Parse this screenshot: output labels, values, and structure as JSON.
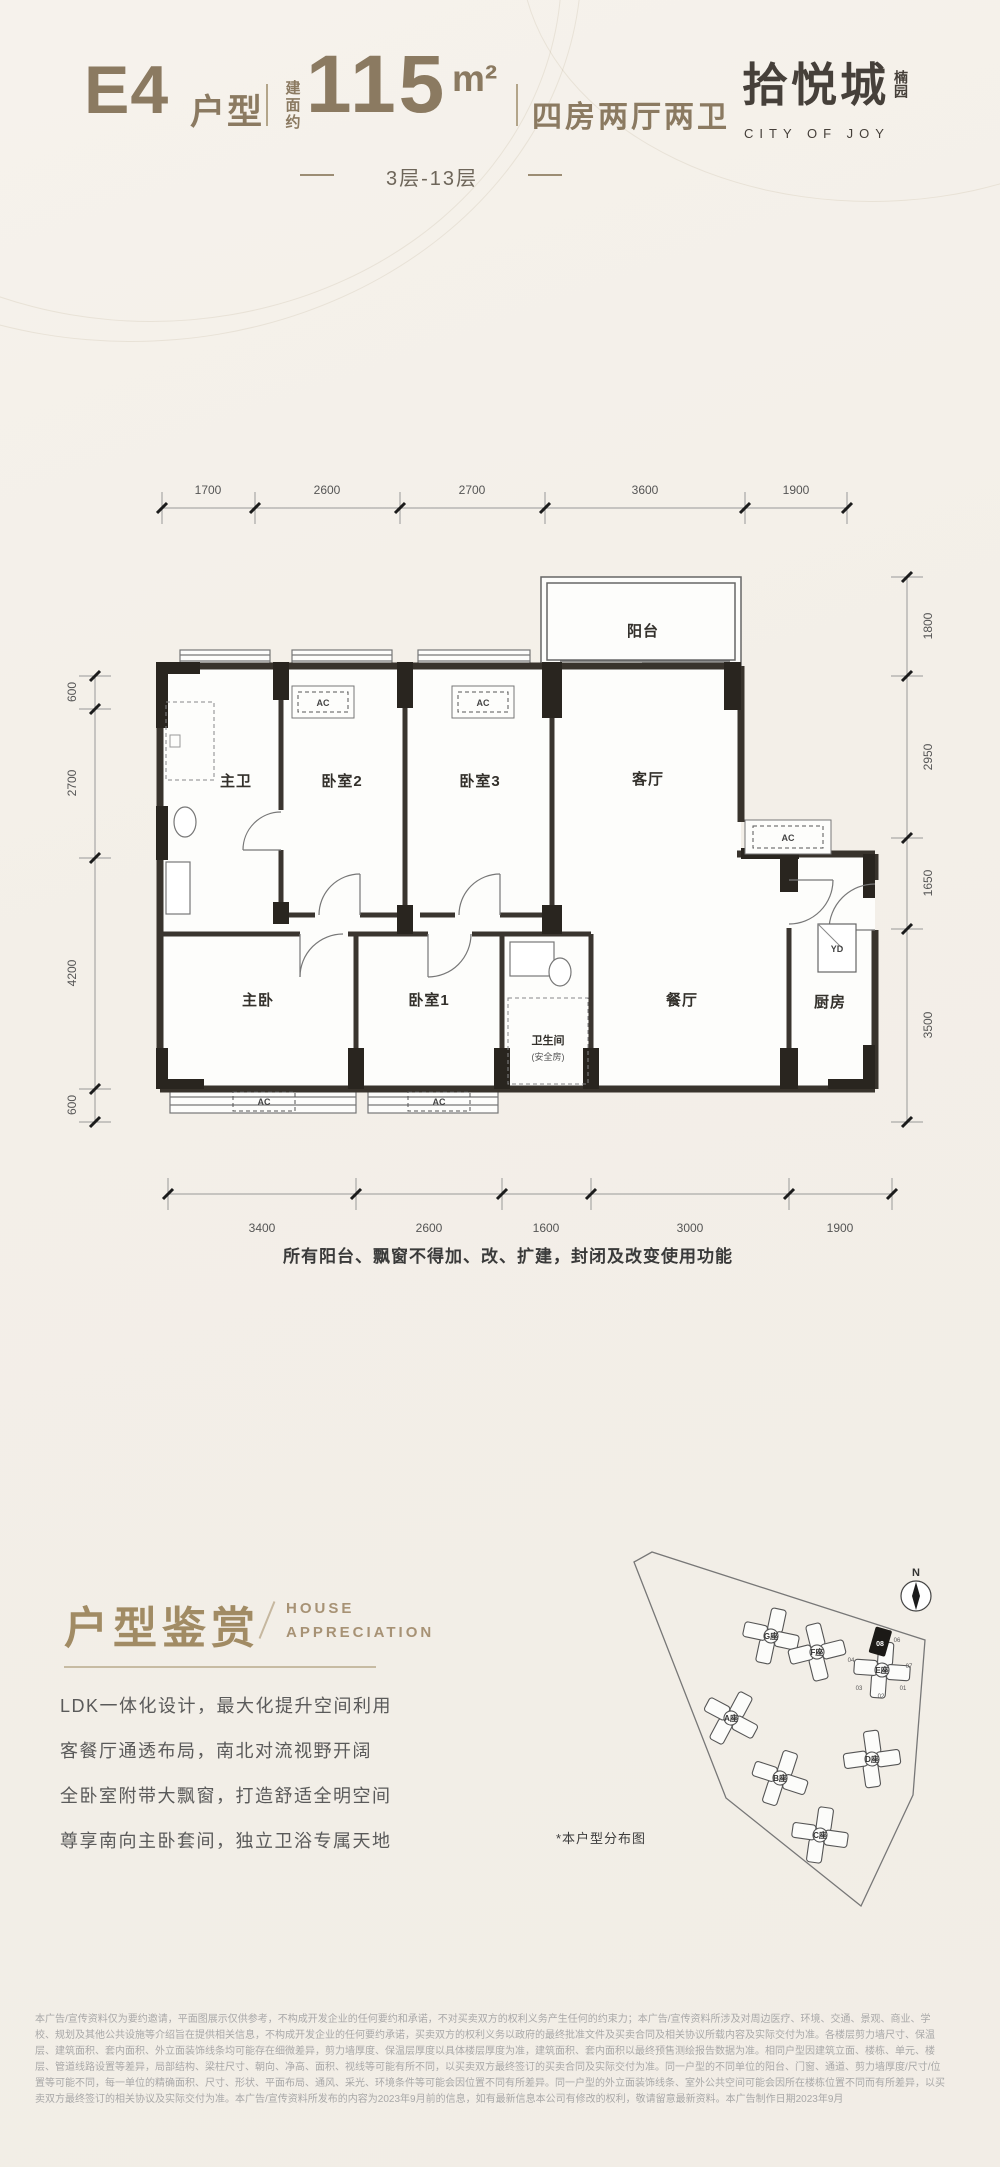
{
  "header": {
    "unit_code": "E4",
    "unit_type_label": "户型",
    "area_prefix": "建面约",
    "area_value": "115",
    "area_unit": "m²",
    "layout_desc": "四房两厅两卫",
    "floor_range": "3层-13层",
    "brand": {
      "name": "拾悦城",
      "sub": "楠园",
      "slogan": "CITY OF JOY"
    }
  },
  "floorplan": {
    "dims_top": [
      "1700",
      "2600",
      "2700",
      "3600",
      "1900"
    ],
    "dims_bottom": [
      "3400",
      "2600",
      "1600",
      "3000",
      "1900"
    ],
    "dims_left": [
      "600",
      "2700",
      "4200",
      "600"
    ],
    "dims_right": [
      "1800",
      "2950",
      "1650",
      "3500"
    ],
    "rooms": {
      "balcony": "阳台",
      "master_bath": "主卫",
      "bedroom2": "卧室2",
      "bedroom3": "卧室3",
      "living": "客厅",
      "master_bedroom": "主卧",
      "bedroom1": "卧室1",
      "bathroom": "卫生间",
      "bathroom_sub": "(安全房)",
      "dining": "餐厅",
      "kitchen": "厨房"
    },
    "ac_label": "AC",
    "yd_label": "YD",
    "note": "所有阳台、飘窗不得加、改、扩建，封闭及改变使用功能"
  },
  "appreciation": {
    "title": "户型鉴赏",
    "subtitle_line1": "HOUSE",
    "subtitle_line2": "APPRECIATION",
    "points": [
      "LDK一体化设计，最大化提升空间利用",
      "客餐厅通透布局，南北对流视野开阔",
      "全卧室附带大飘窗，打造舒适全明空间",
      "尊享南向主卧套间，独立卫浴专属天地"
    ]
  },
  "siteplan": {
    "caption": "*本户型分布图",
    "compass_label": "N",
    "buildings": {
      "a": "A座",
      "b": "B座",
      "c": "C座",
      "d": "D座",
      "e": "E座",
      "f": "F座",
      "g": "G座"
    },
    "units": {
      "u01": "01",
      "u02": "02",
      "u03": "03",
      "u04": "04",
      "u06": "06",
      "u07": "07",
      "u08": "08"
    }
  },
  "disclaimer": [
    "本广告/宣传资料仅为要约邀请，平面图展示仅供参考，不构成开发企业的任何要约和承诺，不对买卖双方的权利义务产生任何的约束力；本广告/宣传资料所涉及对周边医疗、环境、交通、景观、商业、学",
    "校、规划及其他公共设施等介绍旨在提供相关信息，不构成开发企业的任何要约承诺，买卖双方的权利义务以政府的最终批准文件及买卖合同及相关协议所载内容及实际交付为准。各楼层剪力墙尺寸、保温",
    "层、建筑面积、套内面积、外立面装饰线条均可能存在细微差异，剪力墙厚度、保温层厚度以具体楼层厚度为准，建筑面积、套内面积以最终预售测绘报告数据为准。相同户型因建筑立面、楼栋、单元、楼",
    "层、管道线路设置等差异，局部结构、梁柱尺寸、朝向、净高、面积、视线等可能有所不同，以买卖双方最终签订的买卖合同及实际交付为准。同一户型的不同单位的阳台、门窗、通道、剪力墙厚度/尺寸/位",
    "置等可能不同，每一单位的精确面积、尺寸、形状、平面布局、通风、采光、环境条件等可能会因位置不同有所差异。同一户型的外立面装饰线条、室外公共空间可能会因所在楼栋位置不同而有所差异，以买",
    "卖双方最终签订的相关协议及实际交付为准。本广告/宣传资料所发布的内容为2023年9月前的信息，如有最新信息本公司有修改的权利，敬请留意最新资料。本广告制作日期2023年9月"
  ]
}
